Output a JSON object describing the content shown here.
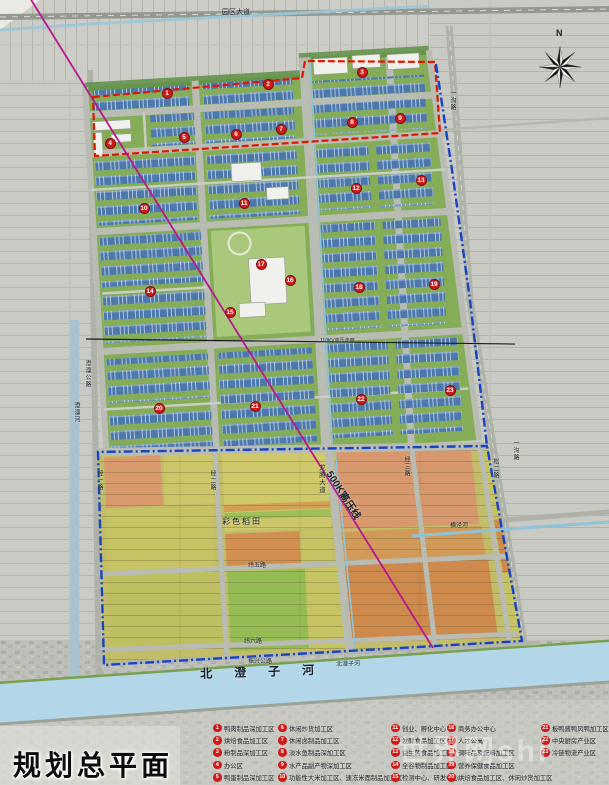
{
  "title": "规划总平面",
  "watermark": "世界网shi",
  "north_label": "N",
  "colors": {
    "red": "#e01800",
    "blue": "#1743c6",
    "hv": "#b8188f",
    "marker": "#cc1b1b",
    "river": "#b3d7e8",
    "building": "#4d78ac"
  },
  "legend": {
    "columns": [
      [
        {
          "n": "1",
          "label": "鸭肉制品深加工区"
        },
        {
          "n": "2",
          "label": "烘焙食品加工区"
        },
        {
          "n": "3",
          "label": "粉制品深加工区"
        },
        {
          "n": "4",
          "label": "办公区"
        },
        {
          "n": "5",
          "label": "鸭蛋制品深加工区"
        }
      ],
      [
        {
          "n": "6",
          "label": "休闲炒货加工区"
        },
        {
          "n": "7",
          "label": "休闲卤制品加工区"
        },
        {
          "n": "8",
          "label": "淡水鱼制品深加工区"
        },
        {
          "n": "9",
          "label": "水产品副产物深加工区"
        },
        {
          "n": "10",
          "label": "功能性大米加工区、速冻米面制品加工区"
        }
      ],
      [
        {
          "n": "11",
          "label": "创业、孵化中心"
        },
        {
          "n": "12",
          "label": "发酵食品加工区"
        },
        {
          "n": "13",
          "label": "益生菌食品加工区"
        },
        {
          "n": "14",
          "label": "全谷物制品加工区"
        },
        {
          "n": "15",
          "label": "检测中心、研发中心"
        }
      ],
      [
        {
          "n": "16",
          "label": "商务办公中心"
        },
        {
          "n": "17",
          "label": "人才公寓"
        },
        {
          "n": "18",
          "label": "调味品及配料加工区"
        },
        {
          "n": "19",
          "label": "营养保健食品加工区"
        },
        {
          "n": "20",
          "label": "烘焙食品加工区、休闲炒货加工区"
        }
      ],
      [
        {
          "n": "21",
          "label": "板鸭酱鸭风鸭加工区"
        },
        {
          "n": "22",
          "label": "中央厨房产业区"
        },
        {
          "n": "23",
          "label": "冷链物流产业区"
        }
      ]
    ]
  },
  "map_labels": [
    {
      "text": "园区大道",
      "x": 222,
      "y": 9,
      "size": 7
    },
    {
      "text": "一沟路",
      "x": 449,
      "y": 90,
      "size": 6,
      "v": 1
    },
    {
      "text": "一沟路",
      "x": 512,
      "y": 440,
      "size": 6,
      "v": 1
    },
    {
      "text": "澄潼公路",
      "x": 84,
      "y": 360,
      "size": 6,
      "v": 1
    },
    {
      "text": "澄潼河",
      "x": 73,
      "y": 402,
      "size": 6,
      "v": 1
    },
    {
      "text": "经一路",
      "x": 96,
      "y": 470,
      "size": 6,
      "v": 1
    },
    {
      "text": "经二路",
      "x": 209,
      "y": 470,
      "size": 6,
      "v": 1
    },
    {
      "text": "龙腾大道",
      "x": 317,
      "y": 464,
      "size": 6.5,
      "v": 1
    },
    {
      "text": "经三路",
      "x": 403,
      "y": 456,
      "size": 6,
      "v": 1
    },
    {
      "text": "松二路",
      "x": 492,
      "y": 458,
      "size": 6,
      "v": 1
    },
    {
      "text": "500KV",
      "x": 332,
      "y": 470,
      "size": 10,
      "rotate": 57,
      "bold": 1
    },
    {
      "text": "高压线",
      "x": 345,
      "y": 491,
      "size": 10,
      "rotate": 57,
      "bold": 1
    },
    {
      "text": "110KV高压走廊",
      "x": 320,
      "y": 339,
      "size": 5
    },
    {
      "text": "彩色稻田",
      "x": 222,
      "y": 518,
      "size": 8,
      "spacing": 2
    },
    {
      "text": "纬五路",
      "x": 248,
      "y": 563,
      "size": 6
    },
    {
      "text": "纬六路",
      "x": 244,
      "y": 639,
      "size": 6
    },
    {
      "text": "振兴公路",
      "x": 248,
      "y": 659,
      "size": 6
    },
    {
      "text": "横泾河",
      "x": 450,
      "y": 523,
      "size": 6
    },
    {
      "text": "北澄子河",
      "x": 200,
      "y": 668,
      "size": 12,
      "spacing": 22,
      "rotate": -2,
      "bold": 1
    },
    {
      "text": "北澄子河",
      "x": 336,
      "y": 662,
      "size": 6,
      "rotate": -2
    }
  ],
  "zone_markers": [
    {
      "n": "1",
      "x": 167,
      "y": 93
    },
    {
      "n": "2",
      "x": 268,
      "y": 84
    },
    {
      "n": "3",
      "x": 362,
      "y": 72
    },
    {
      "n": "4",
      "x": 110,
      "y": 143
    },
    {
      "n": "5",
      "x": 184,
      "y": 137
    },
    {
      "n": "6",
      "x": 236,
      "y": 134
    },
    {
      "n": "7",
      "x": 281,
      "y": 129
    },
    {
      "n": "8",
      "x": 352,
      "y": 122
    },
    {
      "n": "9",
      "x": 400,
      "y": 118
    },
    {
      "n": "10",
      "x": 144,
      "y": 208
    },
    {
      "n": "11",
      "x": 244,
      "y": 203
    },
    {
      "n": "12",
      "x": 356,
      "y": 188
    },
    {
      "n": "13",
      "x": 421,
      "y": 180
    },
    {
      "n": "14",
      "x": 150,
      "y": 291
    },
    {
      "n": "15",
      "x": 230,
      "y": 312
    },
    {
      "n": "16",
      "x": 290,
      "y": 280
    },
    {
      "n": "17",
      "x": 261,
      "y": 264
    },
    {
      "n": "18",
      "x": 359,
      "y": 287
    },
    {
      "n": "19",
      "x": 434,
      "y": 284
    },
    {
      "n": "20",
      "x": 159,
      "y": 408
    },
    {
      "n": "21",
      "x": 255,
      "y": 406
    },
    {
      "n": "22",
      "x": 361,
      "y": 399
    },
    {
      "n": "23",
      "x": 450,
      "y": 390
    }
  ]
}
